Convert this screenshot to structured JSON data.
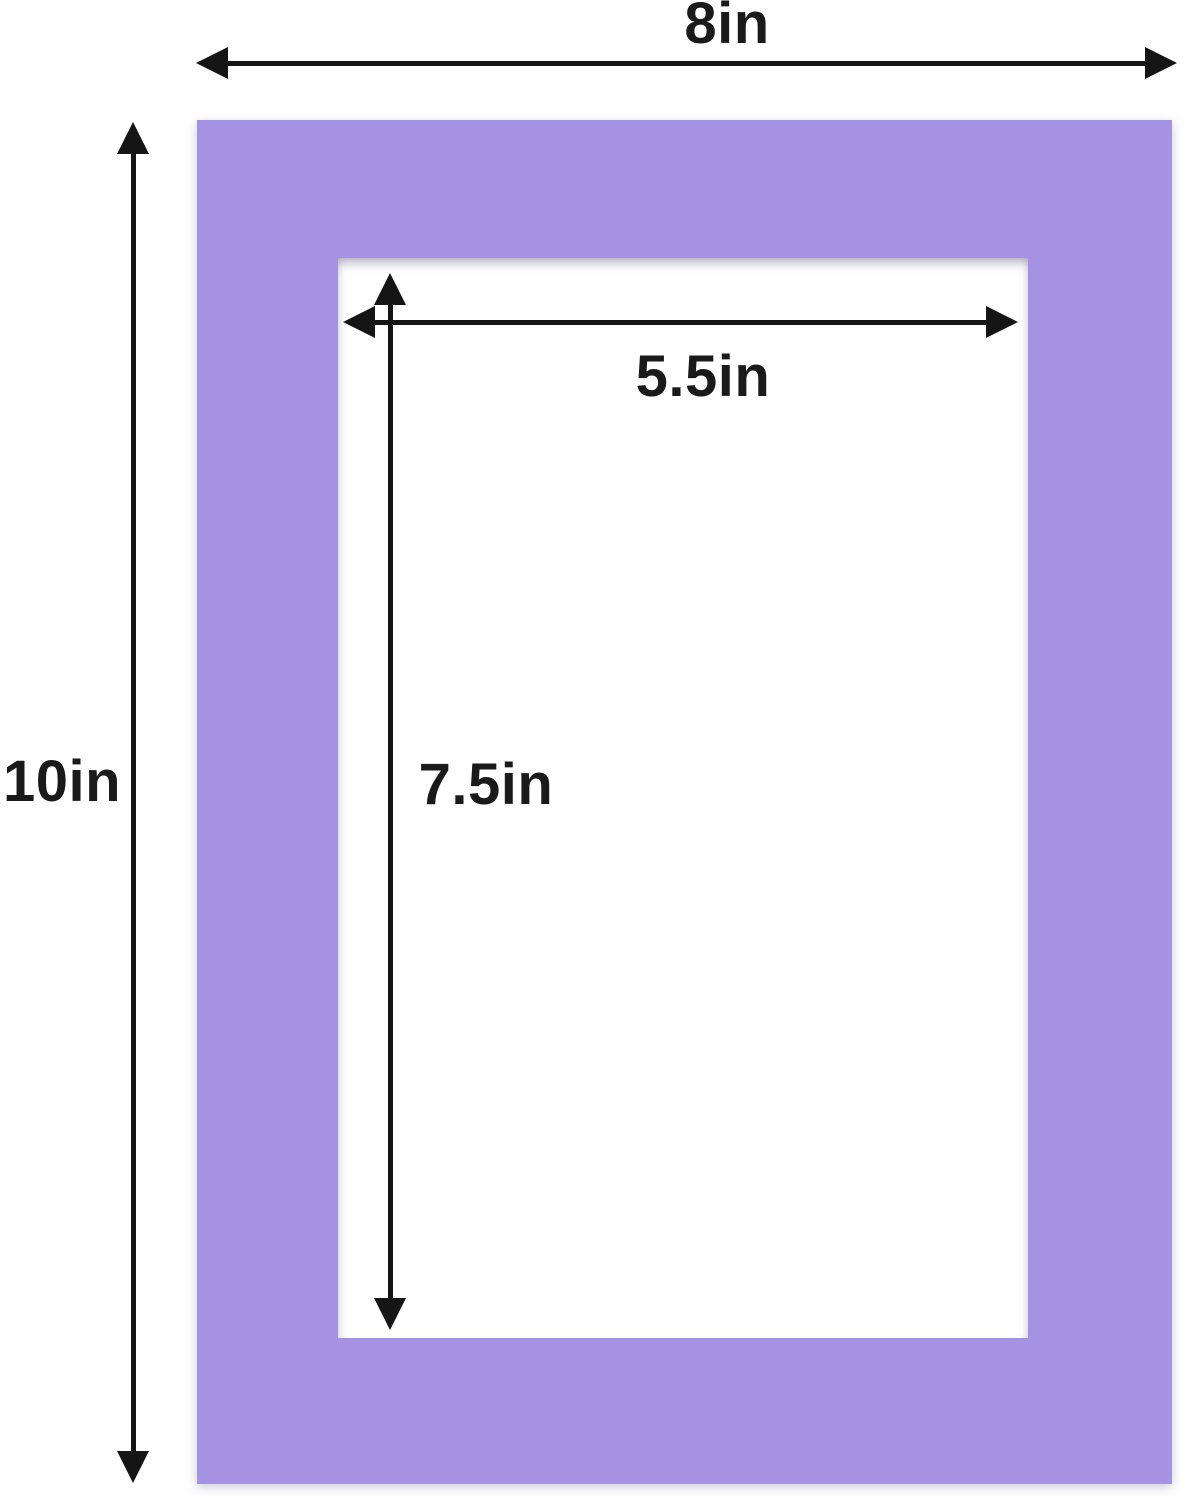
{
  "diagram": {
    "description": "Picture frame mat board dimension diagram",
    "colors": {
      "mat": "#a692e2",
      "arrow": "#151515",
      "background": "#ffffff",
      "opening": "#ffffff"
    },
    "dimensions": {
      "outer_width": {
        "label": "8in"
      },
      "outer_height": {
        "label": "10in"
      },
      "inner_width": {
        "label": "5.5in"
      },
      "inner_height": {
        "label": "7.5in"
      }
    }
  }
}
